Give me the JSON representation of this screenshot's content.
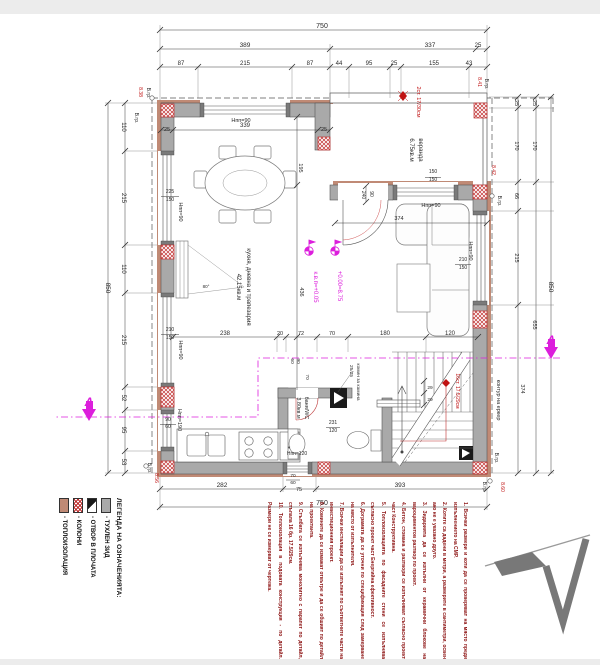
{
  "page": {
    "background": "#ffffff",
    "band_color": "#ececec"
  },
  "colors": {
    "dim": "#2a2a2a",
    "red": "#c01414",
    "magenta": "#dc1edc",
    "note": "#8b1010",
    "wall": "#a9a9a9",
    "insulation": "#c08a75"
  },
  "labels": [
    [
      "750",
      322,
      28,
      0,
      "dim",
      7
    ],
    [
      "389",
      245,
      47,
      0,
      "dim",
      6.5
    ],
    [
      "337",
      430,
      47,
      0,
      "dim",
      6.5
    ],
    [
      "25",
      478,
      47,
      0,
      "dim",
      6
    ],
    [
      "87",
      181,
      65,
      0,
      "dim",
      6
    ],
    [
      "215",
      245,
      65,
      0,
      "dim",
      6
    ],
    [
      "87",
      310,
      65,
      0,
      "dim",
      6
    ],
    [
      "44",
      339,
      65,
      0,
      "dim",
      6
    ],
    [
      "95",
      369,
      65,
      0,
      "dim",
      6
    ],
    [
      "25",
      394,
      65,
      0,
      "dim",
      6
    ],
    [
      "155",
      434,
      65,
      0,
      "dim",
      6
    ],
    [
      "43",
      469,
      65,
      0,
      "dim",
      6
    ],
    [
      "2ст. 17/30см",
      417,
      102,
      90,
      "red",
      5.5
    ],
    [
      "8.41",
      478,
      82,
      90,
      "red",
      5
    ],
    [
      "В.гр.",
      485,
      84,
      90,
      "dim",
      5
    ],
    [
      "8.38",
      139,
      92,
      90,
      "red",
      5
    ],
    [
      "В.гр.",
      147,
      93,
      90,
      "dim",
      5
    ],
    [
      "В.гр.",
      135,
      118,
      90,
      "dim",
      5
    ],
    [
      "Нпп=90",
      241,
      122,
      0,
      "dim",
      5.5
    ],
    [
      "25",
      167,
      131,
      0,
      "dim",
      5.5
    ],
    [
      "339",
      245,
      127,
      0,
      "dim",
      6
    ],
    [
      "25",
      324,
      131,
      0,
      "dim",
      5.5
    ],
    [
      "195",
      299,
      168,
      90,
      "dim",
      5.5
    ],
    [
      "веранда",
      419,
      150,
      90,
      "dim",
      6
    ],
    [
      "6.75кв.м",
      410,
      150,
      90,
      "dim",
      6
    ],
    [
      "150",
      433,
      173,
      0,
      "dim",
      5
    ],
    [
      "150",
      433,
      181,
      0,
      "dim",
      5
    ],
    [
      "Нпп=90",
      431,
      207,
      0,
      "dim",
      5.5
    ],
    [
      "90",
      370,
      194,
      90,
      "dim",
      5
    ],
    [
      "240",
      362,
      195,
      90,
      "dim",
      5
    ],
    [
      "8.42",
      492,
      170,
      90,
      "red",
      5
    ],
    [
      "В.гр.",
      498,
      201,
      90,
      "dim",
      5
    ],
    [
      "225",
      170,
      193,
      0,
      "dim",
      5
    ],
    [
      "150",
      170,
      201,
      0,
      "dim",
      5
    ],
    [
      "Нпп=90",
      179,
      212,
      90,
      "dim",
      5.5
    ],
    [
      "210",
      170,
      331,
      0,
      "dim",
      5
    ],
    [
      "150",
      170,
      339,
      0,
      "dim",
      5
    ],
    [
      "Нпп=90",
      179,
      350,
      90,
      "dim",
      5.5
    ],
    [
      "90",
      168,
      421,
      0,
      "dim",
      5
    ],
    [
      "60",
      168,
      428,
      0,
      "dim",
      5
    ],
    [
      "Нпп=190",
      178,
      420,
      90,
      "dim",
      5.5
    ],
    [
      "кухня, дневна и трапезария",
      247,
      287,
      90,
      "dim",
      6
    ],
    [
      "42.15кв.м",
      237,
      287,
      90,
      "dim",
      6
    ],
    [
      "+0.00=8.75",
      338,
      286,
      90,
      "magenta",
      6
    ],
    [
      "к.в.п=+0.05",
      314,
      287,
      90,
      "magenta",
      6
    ],
    [
      "80°",
      206,
      288,
      0,
      "dim",
      4.5
    ],
    [
      "436",
      300,
      292,
      90,
      "dim",
      5.5
    ],
    [
      "374",
      399,
      220,
      0,
      "dim",
      5.5
    ],
    [
      "Нпп=90",
      469,
      251,
      90,
      "dim",
      5.5
    ],
    [
      "210",
      463,
      261,
      0,
      "dim",
      5
    ],
    [
      "150",
      463,
      269,
      0,
      "dim",
      5
    ],
    [
      "110",
      122,
      127,
      90,
      "dim",
      6
    ],
    [
      "215",
      122,
      198,
      90,
      "dim",
      6
    ],
    [
      "110",
      122,
      269,
      90,
      "dim",
      6
    ],
    [
      "215",
      122,
      340,
      90,
      "dim",
      6
    ],
    [
      "52",
      122,
      398,
      90,
      "dim",
      6
    ],
    [
      "95",
      122,
      430,
      90,
      "dim",
      6
    ],
    [
      "53",
      122,
      462,
      90,
      "dim",
      6
    ],
    [
      "850",
      106,
      288,
      90,
      "dim",
      6.5
    ],
    [
      "25",
      515,
      103,
      90,
      "dim",
      5.5
    ],
    [
      "170",
      515,
      146,
      90,
      "dim",
      5.5
    ],
    [
      "66",
      515,
      196,
      90,
      "dim",
      5.5
    ],
    [
      "215",
      515,
      258,
      90,
      "dim",
      5.5
    ],
    [
      "374",
      521,
      389,
      90,
      "dim",
      5.5
    ],
    [
      "25",
      533,
      103,
      90,
      "dim",
      5.5
    ],
    [
      "170",
      533,
      146,
      90,
      "dim",
      5.5
    ],
    [
      "655",
      533,
      325,
      90,
      "dim",
      5.5
    ],
    [
      "850",
      549,
      287,
      90,
      "dim",
      6.5
    ],
    [
      "контур на еркер",
      497,
      400,
      90,
      "dim",
      5.5
    ],
    [
      "238",
      225,
      335,
      0,
      "dim",
      6
    ],
    [
      "20",
      280,
      335,
      0,
      "dim",
      5.5
    ],
    [
      "72",
      301,
      335,
      0,
      "dim",
      5.5
    ],
    [
      "70",
      332,
      335,
      0,
      "dim",
      5.5
    ],
    [
      "180",
      385,
      335,
      0,
      "dim",
      6
    ],
    [
      "120",
      450,
      335,
      0,
      "dim",
      6
    ],
    [
      "комин за камина",
      357,
      382,
      90,
      "dim",
      4.8
    ],
    [
      "25/25",
      350,
      371,
      90,
      "dim",
      4.8
    ],
    [
      "16ст. 17.5/29см",
      456,
      391,
      90,
      "red",
      5
    ],
    [
      "29",
      430,
      389,
      0,
      "dim",
      4.8
    ],
    [
      "29",
      430,
      401,
      0,
      "dim",
      4.8
    ],
    [
      "231",
      333,
      424,
      0,
      "dim",
      5
    ],
    [
      "120",
      333,
      432,
      0,
      "dim",
      5
    ],
    [
      "баня/WC",
      305,
      408,
      90,
      "dim",
      5.5
    ],
    [
      "3.80кв.м",
      297,
      408,
      90,
      "dim",
      5.5
    ],
    [
      "90",
      297,
      361,
      90,
      "dim",
      4.8
    ],
    [
      "60",
      291,
      361,
      90,
      "dim",
      4.8
    ],
    [
      "70",
      306,
      377,
      90,
      "dim",
      4.8
    ],
    [
      "Нпп=120",
      297,
      455,
      0,
      "dim",
      5
    ],
    [
      "*",
      289,
      451,
      0,
      "dim",
      7
    ],
    [
      "282",
      222,
      487,
      0,
      "dim",
      6.5
    ],
    [
      "75",
      299,
      491,
      0,
      "dim",
      5.5
    ],
    [
      "393",
      400,
      487,
      0,
      "dim",
      6.5
    ],
    [
      "750",
      322,
      505,
      0,
      "dim",
      7
    ],
    [
      "70",
      293,
      477,
      0,
      "dim",
      4.8
    ],
    [
      "60",
      293,
      484,
      0,
      "dim",
      4.8
    ],
    [
      "В.гр.",
      148,
      468,
      90,
      "dim",
      5
    ],
    [
      "8.56",
      155,
      478,
      90,
      "red",
      5
    ],
    [
      "В.гр.",
      495,
      458,
      90,
      "dim",
      5
    ],
    [
      "8.60",
      501,
      487,
      90,
      "red",
      5
    ],
    [
      "В.гр.",
      483,
      487,
      90,
      "dim",
      5
    ],
    [
      "A",
      551,
      344,
      0,
      "magenta",
      12,
      1
    ],
    [
      "A",
      89,
      406,
      0,
      "magenta",
      12,
      1
    ]
  ],
  "legend": {
    "title": "ЛЕГЕНДА НА ОЗНАЧЕНИЯТА:",
    "items": [
      {
        "key": "brick-wall",
        "label": "- ТУХЛЕН ЗИД"
      },
      {
        "key": "slab-opening",
        "label": "- ОТВОР В ПЛОЧАТА"
      },
      {
        "key": "columns",
        "label": "- КОЛОНИ"
      },
      {
        "key": "insulation",
        "label": "- ТОПЛОИЗОЛАЦИЯ"
      }
    ]
  },
  "notes": [
    "1. Всички размери и коти да се проверяват на място преди изпълнението на СМР.",
    "2. Котите са дадени в метри, а размерите в сантиметри, освен ако не е указано друго.",
    "3. Зидарията да се изпълни от керамични блокове на вароциментов разтвор по проект.",
    "4. Бетон, стомана и разтвори се изпълняват съгласно проект част Конструктивна.",
    "5. Топлоизолацията по фасадните стени се изпълнява съгласно проект част Енергийна ефективност.",
    "6. Дограмата да се уточни по спецификация след замерване на място от изпълнителя.",
    "7. Всички инсталации да се изпълнят по съответните части на инвестиционния проект.",
    "8. Комините да се измажат отвътре и да се обшият по детайл на проектанта.",
    "9. Стълбата се изпълнява монолитно с парапет по детайл, стъпала 16 бр. 17.5/29см.",
    "10. Топлоизолация в подовата конструкция - по детайл. Размери не се измерват от чертежа."
  ],
  "section_marker": {
    "letter": "A"
  },
  "elevation_marks": {
    "plus_zero": "+0.00=8.75",
    "kvp": "к.в.п=+0.05"
  }
}
